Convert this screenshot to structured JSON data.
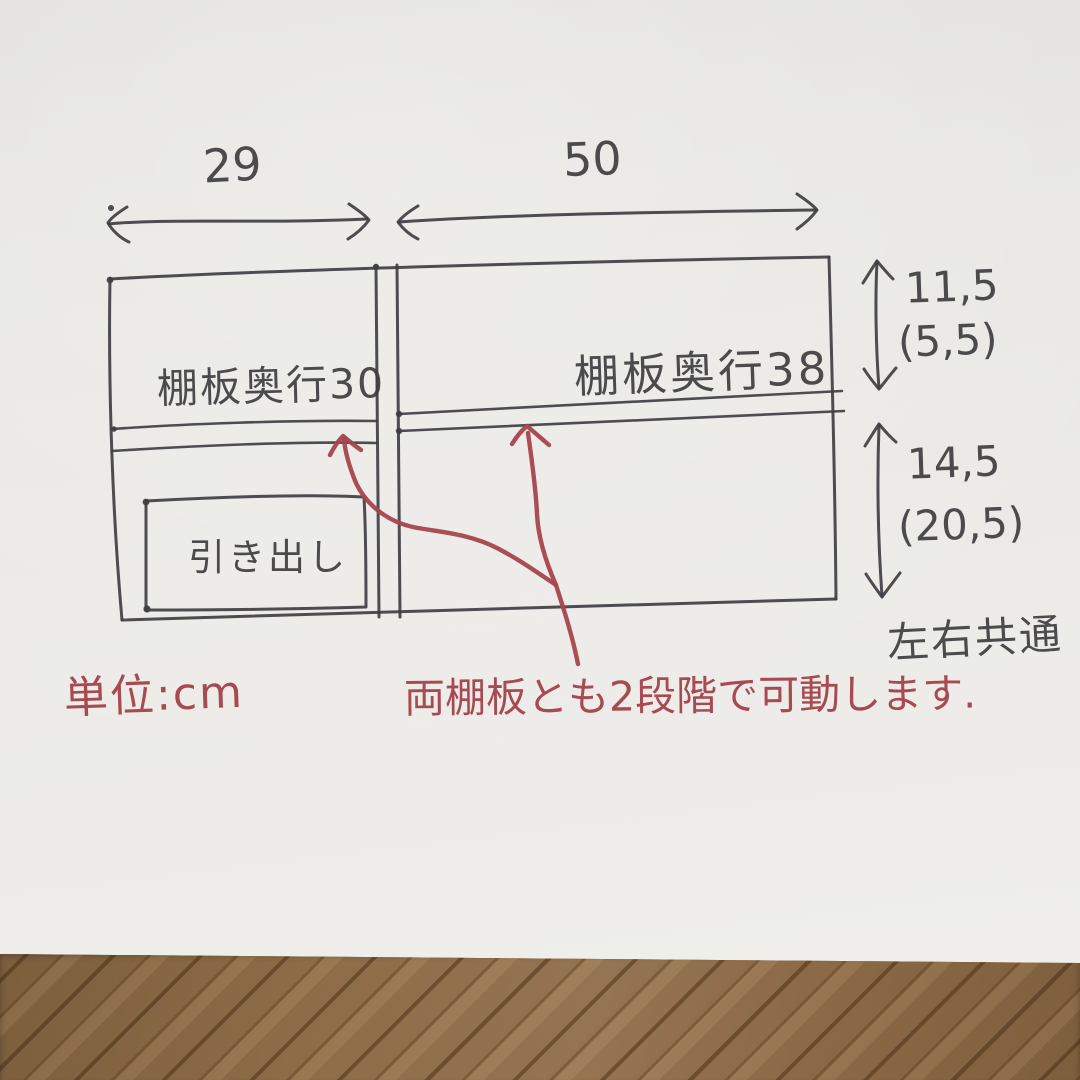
{
  "sketch": {
    "top_dims": {
      "left": "29",
      "right": "50"
    },
    "labels": {
      "left_shelf": "棚板奥行30",
      "right_shelf": "棚板奥行38",
      "drawer": "引き出し",
      "both_sides": "左右共通"
    },
    "right_dims": {
      "upper": "11,5",
      "upper_paren": "(5,5)",
      "lower": "14,5",
      "lower_paren": "(20,5)"
    },
    "notes": {
      "unit": "単位:cm",
      "movable": "両棚板とも2段階で可動します."
    },
    "colors": {
      "ink": "#3f3e42",
      "red_ink": "#a6454e",
      "paper": "#e8e7e3",
      "floor": "#8a6845"
    }
  }
}
